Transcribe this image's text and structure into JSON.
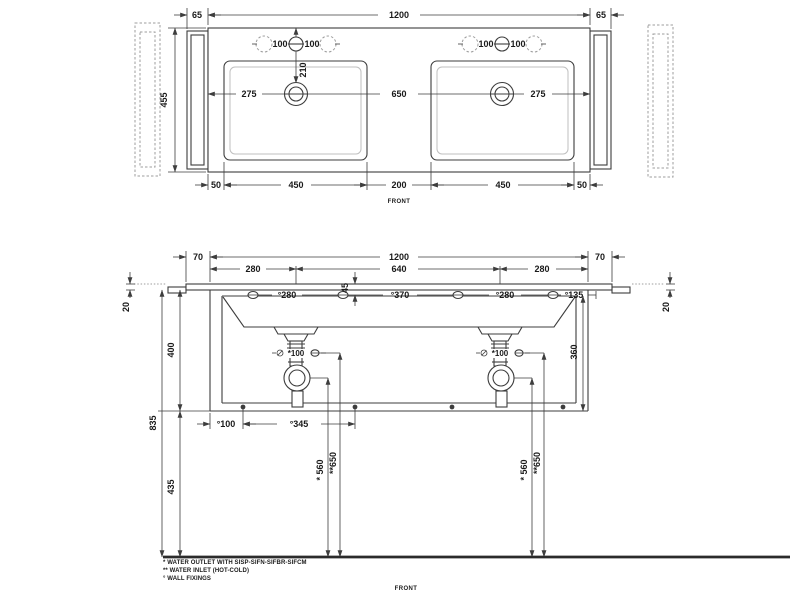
{
  "colors": {
    "line": "#3d3d3d",
    "dashed_line": "#9e9e9e",
    "basin_inner_line": "#bfbfbf",
    "background": "#ffffff"
  },
  "top_view": {
    "view_label": "FRONT",
    "dim_side_panel_left": "65",
    "dim_total_width": "1200",
    "dim_side_panel_right": "65",
    "dim_depth": "455",
    "dim_tap_left_a": "100",
    "dim_tap_left_b": "100",
    "dim_tap_right_a": "100",
    "dim_tap_right_b": "100",
    "dim_drain_setback": "210",
    "dim_edge_to_drain_left": "275",
    "dim_drain_spacing": "650",
    "dim_edge_to_drain_right": "275",
    "dim_margin_left": "50",
    "dim_basin_left": "450",
    "dim_center_gap": "200",
    "dim_basin_right": "450",
    "dim_margin_right": "50"
  },
  "front_view": {
    "view_label": "FRONT",
    "dim_bracket_left": "70",
    "dim_total_width": "1200",
    "dim_bracket_right": "70",
    "dim_drain_offset_left": "280",
    "dim_drain_spacing": "640",
    "dim_drain_offset_right": "280",
    "dim_top_thickness_left": "20",
    "dim_top_thickness_right": "20",
    "dim_fixing_depth": "45",
    "dim_fixing_1": "°280",
    "dim_fixing_2": "°370",
    "dim_fixing_3": "°280",
    "dim_fixing_4": "°135",
    "dim_height_top": "400",
    "dim_height_total": "835",
    "dim_height_clearance": "435",
    "dim_inner_height": "360",
    "dim_trap_left": "*100",
    "dim_trap_right": "*100",
    "dim_fixing_bottom_1": "°100",
    "dim_fixing_bottom_2": "°345",
    "dim_outlet_height_left": "* 560",
    "dim_inlet_height_left": "**650",
    "dim_outlet_height_right": "* 560",
    "dim_inlet_height_right": "**650"
  },
  "notes": [
    "* WATER OUTLET WITH SISP-SIFN-SIFBR-SIFCM",
    "** WATER INLET  (HOT-COLD)",
    "° WALL FIXINGS"
  ]
}
